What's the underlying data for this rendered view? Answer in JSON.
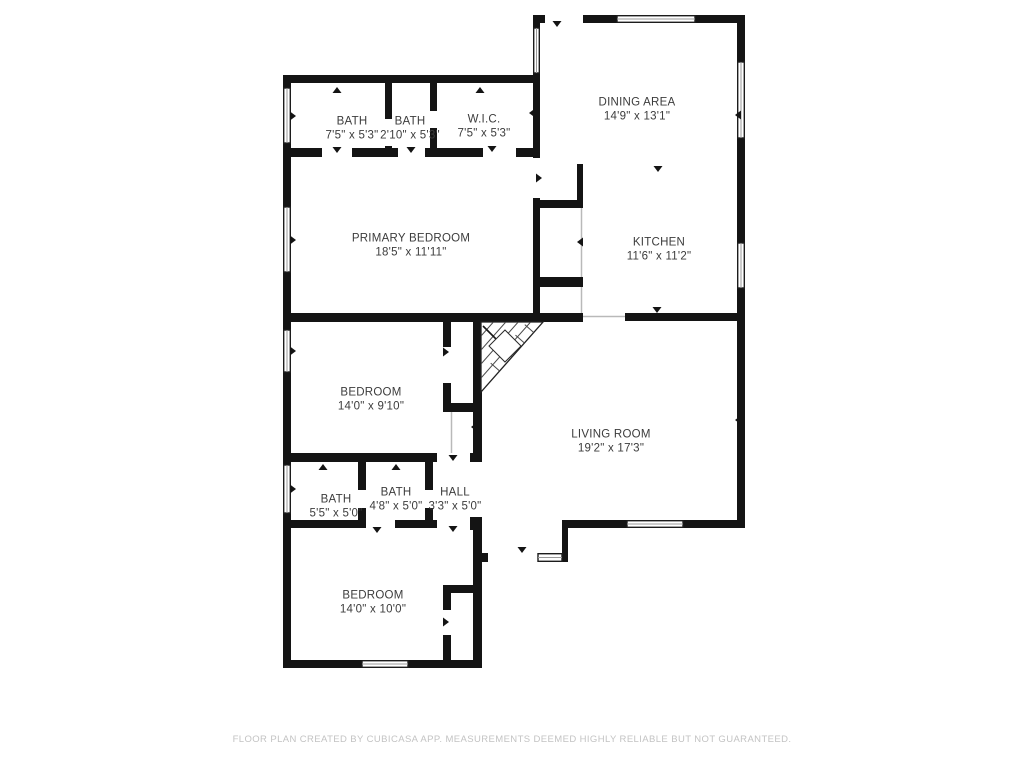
{
  "page": {
    "background": "#ffffff"
  },
  "colors": {
    "wall": "#141414",
    "room_text": "#3c3c3c",
    "footer_text": "#c3c3c3",
    "window_midline": "#999999",
    "open_boundary_line": "#b9b9b9"
  },
  "rooms": [
    {
      "name": "BATH",
      "dims": "7'5\" x 5'3\"",
      "cx": 352,
      "cy": 129
    },
    {
      "name": "BATH",
      "dims": "2'10\" x 5'3\"",
      "cx": 410,
      "cy": 129
    },
    {
      "name": "W.I.C.",
      "dims": "7'5\" x 5'3\"",
      "cx": 484,
      "cy": 127
    },
    {
      "name": "DINING AREA",
      "dims": "14'9\" x 13'1\"",
      "cx": 637,
      "cy": 110
    },
    {
      "name": "PRIMARY BEDROOM",
      "dims": "18'5\" x 11'11\"",
      "cx": 411,
      "cy": 246
    },
    {
      "name": "KITCHEN",
      "dims": "11'6\" x 11'2\"",
      "cx": 659,
      "cy": 250
    },
    {
      "name": "BEDROOM",
      "dims": "14'0\" x 9'10\"",
      "cx": 371,
      "cy": 400
    },
    {
      "name": "LIVING ROOM",
      "dims": "19'2\" x 17'3\"",
      "cx": 611,
      "cy": 442
    },
    {
      "name": "BATH",
      "dims": "5'5\" x 5'0\"",
      "cx": 336,
      "cy": 507
    },
    {
      "name": "BATH",
      "dims": "4'8\" x 5'0\"",
      "cx": 396,
      "cy": 500
    },
    {
      "name": "HALL",
      "dims": "3'3\" x 5'0\"",
      "cx": 455,
      "cy": 500
    },
    {
      "name": "BEDROOM",
      "dims": "14'0\" x 10'0\"",
      "cx": 373,
      "cy": 603
    }
  ],
  "door_markers": [
    {
      "x": 557,
      "y": 27,
      "dir": "down"
    },
    {
      "x": 492,
      "y": 152,
      "dir": "down"
    },
    {
      "x": 337,
      "y": 153,
      "dir": "down"
    },
    {
      "x": 411,
      "y": 153,
      "dir": "down"
    },
    {
      "x": 337,
      "y": 87,
      "dir": "up"
    },
    {
      "x": 480,
      "y": 87,
      "dir": "up"
    },
    {
      "x": 529,
      "y": 113,
      "dir": "left"
    },
    {
      "x": 296,
      "y": 116,
      "dir": "right"
    },
    {
      "x": 296,
      "y": 240,
      "dir": "right"
    },
    {
      "x": 542,
      "y": 178,
      "dir": "right"
    },
    {
      "x": 577,
      "y": 242,
      "dir": "left"
    },
    {
      "x": 658,
      "y": 172,
      "dir": "down"
    },
    {
      "x": 657,
      "y": 313,
      "dir": "down"
    },
    {
      "x": 735,
      "y": 115,
      "dir": "left"
    },
    {
      "x": 735,
      "y": 420,
      "dir": "left"
    },
    {
      "x": 296,
      "y": 351,
      "dir": "right"
    },
    {
      "x": 449,
      "y": 352,
      "dir": "right"
    },
    {
      "x": 471,
      "y": 427,
      "dir": "left"
    },
    {
      "x": 453,
      "y": 461,
      "dir": "down"
    },
    {
      "x": 323,
      "y": 464,
      "dir": "up"
    },
    {
      "x": 396,
      "y": 464,
      "dir": "up"
    },
    {
      "x": 296,
      "y": 489,
      "dir": "right"
    },
    {
      "x": 377,
      "y": 533,
      "dir": "down"
    },
    {
      "x": 453,
      "y": 532,
      "dir": "down"
    },
    {
      "x": 522,
      "y": 553,
      "dir": "down"
    },
    {
      "x": 449,
      "y": 622,
      "dir": "right"
    }
  ],
  "footer": {
    "disclaimer": "FLOOR PLAN CREATED BY CUBICASA APP. MEASUREMENTS DEEMED HIGHLY RELIABLE BUT NOT GUARANTEED."
  }
}
